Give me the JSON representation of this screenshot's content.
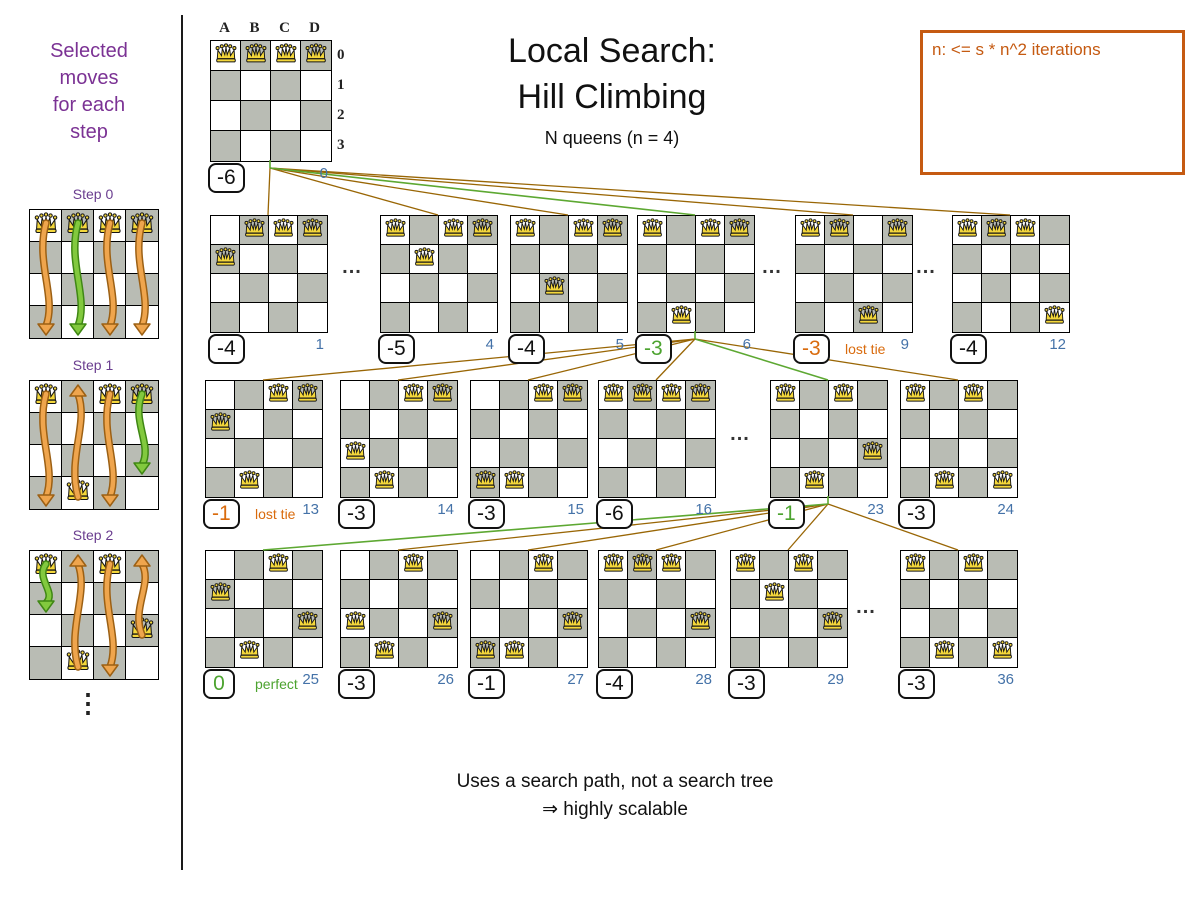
{
  "sidebar": {
    "title_lines": [
      "Selected",
      "moves",
      "for each",
      "step"
    ],
    "ellipsis": "⋮",
    "steps": [
      {
        "id": "step0",
        "label": "Step 0",
        "x": 29,
        "y": 209,
        "queens": [
          [
            0,
            0
          ],
          [
            1,
            0
          ],
          [
            2,
            0
          ],
          [
            3,
            0
          ]
        ],
        "arrows": [
          {
            "col": 0,
            "from": 0,
            "to": 3,
            "color": "orange"
          },
          {
            "col": 1,
            "from": 0,
            "to": 3,
            "color": "green"
          },
          {
            "col": 2,
            "from": 0,
            "to": 3,
            "color": "orange"
          },
          {
            "col": 3,
            "from": 0,
            "to": 3,
            "color": "orange"
          }
        ]
      },
      {
        "id": "step1",
        "label": "Step 1",
        "x": 29,
        "y": 380,
        "queens": [
          [
            0,
            0
          ],
          [
            2,
            0
          ],
          [
            3,
            0
          ],
          [
            1,
            3
          ]
        ],
        "arrows": [
          {
            "col": 0,
            "from": 0,
            "to": 3,
            "color": "orange"
          },
          {
            "col": 1,
            "from": 3,
            "to": 0,
            "color": "orange"
          },
          {
            "col": 2,
            "from": 0,
            "to": 3,
            "color": "orange"
          },
          {
            "col": 3,
            "from": 0,
            "to": 2,
            "color": "green"
          }
        ]
      },
      {
        "id": "step2",
        "label": "Step 2",
        "x": 29,
        "y": 550,
        "queens": [
          [
            0,
            0
          ],
          [
            2,
            0
          ],
          [
            1,
            3
          ],
          [
            3,
            2
          ]
        ],
        "arrows": [
          {
            "col": 0,
            "from": 0,
            "to": 1,
            "color": "green"
          },
          {
            "col": 1,
            "from": 3,
            "to": 0,
            "color": "orange"
          },
          {
            "col": 2,
            "from": 0,
            "to": 3,
            "color": "orange"
          },
          {
            "col": 3,
            "from": 2,
            "to": 0,
            "color": "orange"
          }
        ]
      }
    ]
  },
  "header": {
    "title_line1": "Local Search:",
    "title_line2": "Hill Climbing",
    "subtitle": "N queens (n = 4)"
  },
  "note_box": {
    "text": "n: <= s * n^2 iterations"
  },
  "footer": {
    "line1": "Uses a search path, not a search tree",
    "line2": "⇒ highly scalable"
  },
  "root_board": {
    "id": "b0",
    "x": 210,
    "y": 40,
    "cell": 30,
    "col_labels": [
      "A",
      "B",
      "C",
      "D"
    ],
    "row_labels": [
      "0",
      "1",
      "2",
      "3"
    ],
    "queens": [
      [
        0,
        0
      ],
      [
        1,
        0
      ],
      [
        2,
        0
      ],
      [
        3,
        0
      ]
    ],
    "score": "-6",
    "score_color": "black",
    "index": "0"
  },
  "boards": [
    {
      "id": "b1",
      "x": 210,
      "y": 215,
      "cell": 29,
      "queens": [
        [
          1,
          0
        ],
        [
          2,
          0
        ],
        [
          3,
          0
        ],
        [
          0,
          1
        ]
      ],
      "score": "-4",
      "score_color": "black",
      "index": "1"
    },
    {
      "id": "b4",
      "x": 380,
      "y": 215,
      "cell": 29,
      "queens": [
        [
          0,
          0
        ],
        [
          2,
          0
        ],
        [
          3,
          0
        ],
        [
          1,
          1
        ]
      ],
      "score": "-5",
      "score_color": "black",
      "index": "4"
    },
    {
      "id": "b5",
      "x": 510,
      "y": 215,
      "cell": 29,
      "queens": [
        [
          0,
          0
        ],
        [
          2,
          0
        ],
        [
          3,
          0
        ],
        [
          1,
          2
        ]
      ],
      "score": "-4",
      "score_color": "black",
      "index": "5"
    },
    {
      "id": "b6",
      "x": 637,
      "y": 215,
      "cell": 29,
      "queens": [
        [
          0,
          0
        ],
        [
          2,
          0
        ],
        [
          3,
          0
        ],
        [
          1,
          3
        ]
      ],
      "score": "-3",
      "score_color": "green",
      "index": "6"
    },
    {
      "id": "b9",
      "x": 795,
      "y": 215,
      "cell": 29,
      "queens": [
        [
          0,
          0
        ],
        [
          1,
          0
        ],
        [
          3,
          0
        ],
        [
          2,
          3
        ]
      ],
      "score": "-3",
      "score_color": "orange",
      "index": "9",
      "note": "lost tie",
      "note_color": "orange"
    },
    {
      "id": "b12",
      "x": 952,
      "y": 215,
      "cell": 29,
      "queens": [
        [
          0,
          0
        ],
        [
          1,
          0
        ],
        [
          2,
          0
        ],
        [
          3,
          3
        ]
      ],
      "score": "-4",
      "score_color": "black",
      "index": "12"
    },
    {
      "id": "b13",
      "x": 205,
      "y": 380,
      "cell": 29,
      "queens": [
        [
          2,
          0
        ],
        [
          3,
          0
        ],
        [
          0,
          1
        ],
        [
          1,
          3
        ]
      ],
      "score": "-1",
      "score_color": "orange",
      "index": "13",
      "note": "lost tie",
      "note_color": "orange"
    },
    {
      "id": "b14",
      "x": 340,
      "y": 380,
      "cell": 29,
      "queens": [
        [
          2,
          0
        ],
        [
          3,
          0
        ],
        [
          0,
          2
        ],
        [
          1,
          3
        ]
      ],
      "score": "-3",
      "score_color": "black",
      "index": "14"
    },
    {
      "id": "b15",
      "x": 470,
      "y": 380,
      "cell": 29,
      "queens": [
        [
          2,
          0
        ],
        [
          3,
          0
        ],
        [
          0,
          3
        ],
        [
          1,
          3
        ]
      ],
      "score": "-3",
      "score_color": "black",
      "index": "15"
    },
    {
      "id": "b16",
      "x": 598,
      "y": 380,
      "cell": 29,
      "queens": [
        [
          0,
          0
        ],
        [
          1,
          0
        ],
        [
          2,
          0
        ],
        [
          3,
          0
        ]
      ],
      "score": "-6",
      "score_color": "black",
      "index": "16"
    },
    {
      "id": "b23",
      "x": 770,
      "y": 380,
      "cell": 29,
      "queens": [
        [
          0,
          0
        ],
        [
          2,
          0
        ],
        [
          3,
          2
        ],
        [
          1,
          3
        ]
      ],
      "score": "-1",
      "score_color": "green",
      "index": "23"
    },
    {
      "id": "b24",
      "x": 900,
      "y": 380,
      "cell": 29,
      "queens": [
        [
          0,
          0
        ],
        [
          2,
          0
        ],
        [
          1,
          3
        ],
        [
          3,
          3
        ]
      ],
      "score": "-3",
      "score_color": "black",
      "index": "24"
    },
    {
      "id": "b25",
      "x": 205,
      "y": 550,
      "cell": 29,
      "queens": [
        [
          2,
          0
        ],
        [
          0,
          1
        ],
        [
          3,
          2
        ],
        [
          1,
          3
        ]
      ],
      "score": "0",
      "score_color": "green",
      "index": "25",
      "note": "perfect",
      "note_color": "green"
    },
    {
      "id": "b26",
      "x": 340,
      "y": 550,
      "cell": 29,
      "queens": [
        [
          2,
          0
        ],
        [
          0,
          2
        ],
        [
          3,
          2
        ],
        [
          1,
          3
        ]
      ],
      "score": "-3",
      "score_color": "black",
      "index": "26"
    },
    {
      "id": "b27",
      "x": 470,
      "y": 550,
      "cell": 29,
      "queens": [
        [
          2,
          0
        ],
        [
          3,
          2
        ],
        [
          0,
          3
        ],
        [
          1,
          3
        ]
      ],
      "score": "-1",
      "score_color": "black",
      "index": "27"
    },
    {
      "id": "b28",
      "x": 598,
      "y": 550,
      "cell": 29,
      "queens": [
        [
          0,
          0
        ],
        [
          1,
          0
        ],
        [
          2,
          0
        ],
        [
          3,
          2
        ]
      ],
      "score": "-4",
      "score_color": "black",
      "index": "28"
    },
    {
      "id": "b29",
      "x": 730,
      "y": 550,
      "cell": 29,
      "queens": [
        [
          0,
          0
        ],
        [
          2,
          0
        ],
        [
          1,
          1
        ],
        [
          3,
          2
        ]
      ],
      "score": "-3",
      "score_color": "black",
      "index": "29"
    },
    {
      "id": "b36",
      "x": 900,
      "y": 550,
      "cell": 29,
      "queens": [
        [
          0,
          0
        ],
        [
          2,
          0
        ],
        [
          1,
          3
        ],
        [
          3,
          3
        ]
      ],
      "score": "-3",
      "score_color": "black",
      "index": "36"
    }
  ],
  "dots": [
    {
      "x": 352,
      "y": 256
    },
    {
      "x": 772,
      "y": 256
    },
    {
      "x": 926,
      "y": 256
    },
    {
      "x": 740,
      "y": 423
    },
    {
      "x": 866,
      "y": 596
    }
  ],
  "edges": [
    {
      "from": "b0",
      "to": "b1",
      "green": false
    },
    {
      "from": "b0",
      "to": "b4",
      "green": false
    },
    {
      "from": "b0",
      "to": "b5",
      "green": false
    },
    {
      "from": "b0",
      "to": "b6",
      "green": true
    },
    {
      "from": "b0",
      "to": "b9",
      "green": false
    },
    {
      "from": "b0",
      "to": "b12",
      "green": false
    },
    {
      "from": "b6",
      "to": "b13",
      "green": false
    },
    {
      "from": "b6",
      "to": "b14",
      "green": false
    },
    {
      "from": "b6",
      "to": "b15",
      "green": false
    },
    {
      "from": "b6",
      "to": "b16",
      "green": false
    },
    {
      "from": "b6",
      "to": "b23",
      "green": true
    },
    {
      "from": "b6",
      "to": "b24",
      "green": false
    },
    {
      "from": "b23",
      "to": "b25",
      "green": true
    },
    {
      "from": "b23",
      "to": "b26",
      "green": false
    },
    {
      "from": "b23",
      "to": "b27",
      "green": false
    },
    {
      "from": "b23",
      "to": "b28",
      "green": false
    },
    {
      "from": "b23",
      "to": "b29",
      "green": false
    },
    {
      "from": "b23",
      "to": "b36",
      "green": false
    }
  ],
  "colors": {
    "purple": "#7b3294",
    "note_orange": "#c55a11",
    "score_green": "#4ca32f",
    "score_orange": "#d96b0d",
    "index_blue": "#4472a8",
    "line_brown": "#996605",
    "line_green": "#5da832",
    "cell_gray": "#b9bcb4",
    "queen_gold": "#f4d73b",
    "arrow_orange": "#efa54d",
    "arrow_green": "#82c93e"
  }
}
